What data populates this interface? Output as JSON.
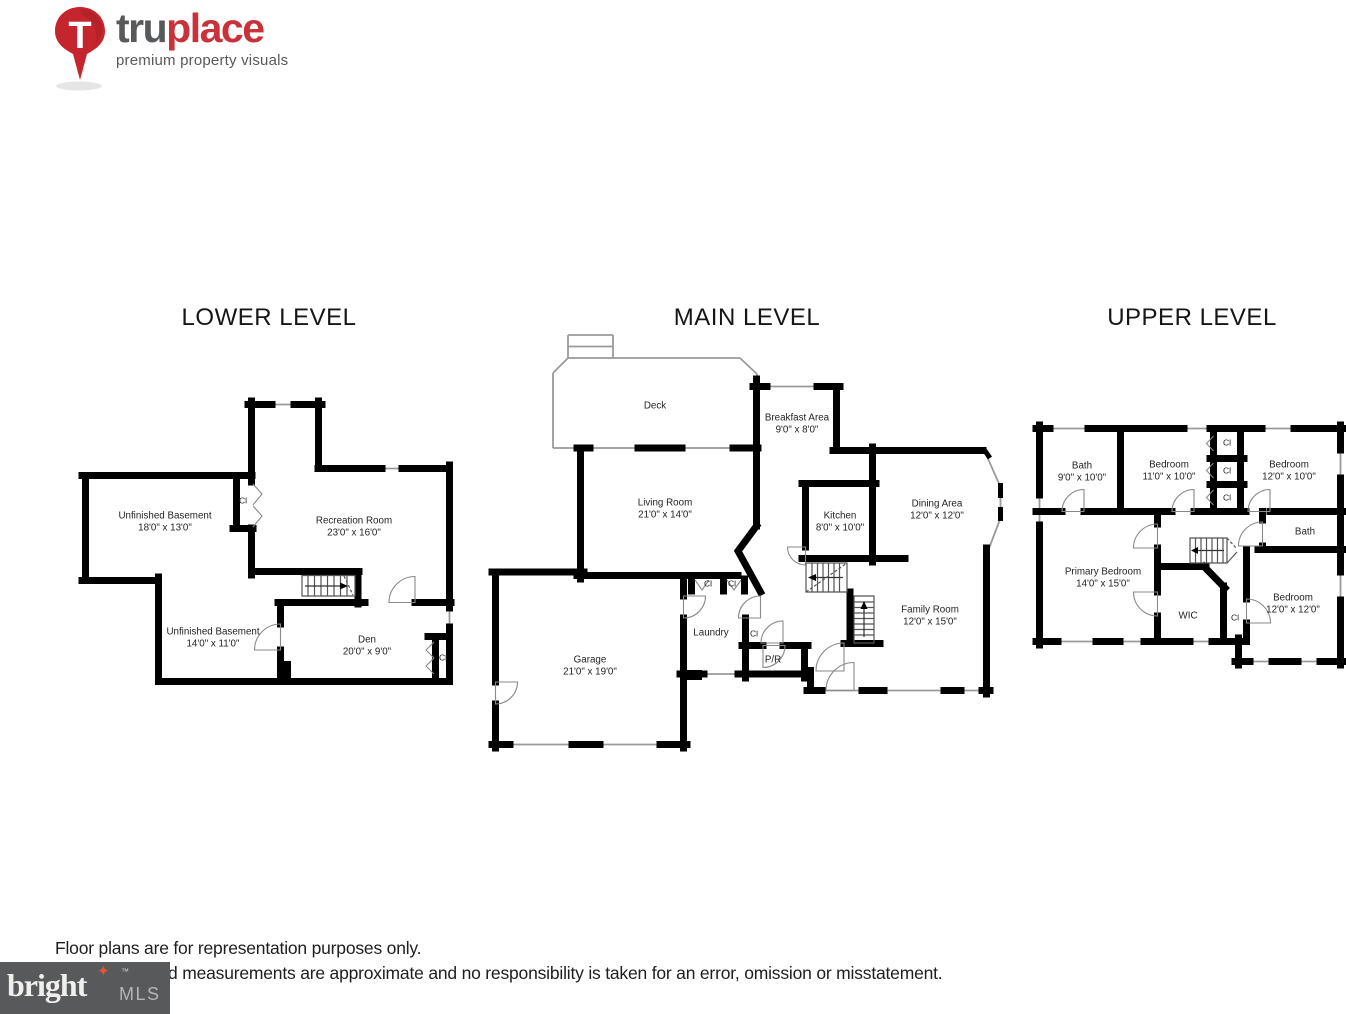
{
  "header": {
    "logo": {
      "brand_bold": "tru",
      "brand_accent": "place",
      "tagline": "premium property visuals"
    }
  },
  "plans": {
    "lower": {
      "title": "LOWER LEVEL",
      "rooms": {
        "unfinished_basement_1": {
          "name": "Unfinished Basement",
          "dims": "18'0\" x 13'0\""
        },
        "recreation_room": {
          "name": "Recreation Room",
          "dims": "23'0\" x 16'0\""
        },
        "unfinished_basement_2": {
          "name": "Unfinished Basement",
          "dims": "14'0\" x 11'0\""
        },
        "den": {
          "name": "Den",
          "dims": "20'0\" x 9'0\""
        },
        "closet_1": {
          "name": "Cl"
        },
        "closet_2": {
          "name": "Cl"
        }
      }
    },
    "main": {
      "title": "MAIN LEVEL",
      "rooms": {
        "deck": {
          "name": "Deck"
        },
        "breakfast_area": {
          "name": "Breakfast Area",
          "dims": "9'0\" x 8'0\""
        },
        "living_room": {
          "name": "Living Room",
          "dims": "21'0\" x 14'0\""
        },
        "kitchen": {
          "name": "Kitchen",
          "dims": "8'0\" x 10'0\""
        },
        "dining_area": {
          "name": "Dining Area",
          "dims": "12'0\" x 12'0\""
        },
        "family_room": {
          "name": "Family Room",
          "dims": "12'0\" x 15'0\""
        },
        "laundry": {
          "name": "Laundry"
        },
        "powder_room": {
          "name": "P/R"
        },
        "garage": {
          "name": "Garage",
          "dims": "21'0\" x 19'0\""
        },
        "closet_1": {
          "name": "Cl"
        },
        "closet_2": {
          "name": "Cl"
        },
        "closet_3": {
          "name": "Cl"
        }
      }
    },
    "upper": {
      "title": "UPPER LEVEL",
      "rooms": {
        "bath_1": {
          "name": "Bath",
          "dims": "9'0\" x 10'0\""
        },
        "bedroom_1": {
          "name": "Bedroom",
          "dims": "11'0\" x 10'0\""
        },
        "bedroom_2": {
          "name": "Bedroom",
          "dims": "12'0\" x 10'0\""
        },
        "primary_bedroom": {
          "name": "Primary Bedroom",
          "dims": "14'0\" x 15'0\""
        },
        "wic": {
          "name": "WIC"
        },
        "bath_2": {
          "name": "Bath"
        },
        "bedroom_3": {
          "name": "Bedroom",
          "dims": "12'0\" x 12'0\""
        },
        "closet_1": {
          "name": "Cl"
        },
        "closet_2": {
          "name": "Cl"
        },
        "closet_3": {
          "name": "Cl"
        },
        "closet_4": {
          "name": "Cl"
        }
      }
    }
  },
  "footer": {
    "disclaimer_line1": "Floor plans are for representation purposes only.",
    "disclaimer_line2": "d measurements are approximate and no responsibility is taken for an error, omission or misstatement.",
    "mls_logo": {
      "brand": "bright",
      "tm": "™",
      "suffix": "MLS"
    }
  },
  "colors": {
    "accent_red": "#c9323a",
    "logo_gray": "#58595b",
    "wall_black": "#000000",
    "mls_bg": "#58595b",
    "mls_star": "#e8542d"
  }
}
